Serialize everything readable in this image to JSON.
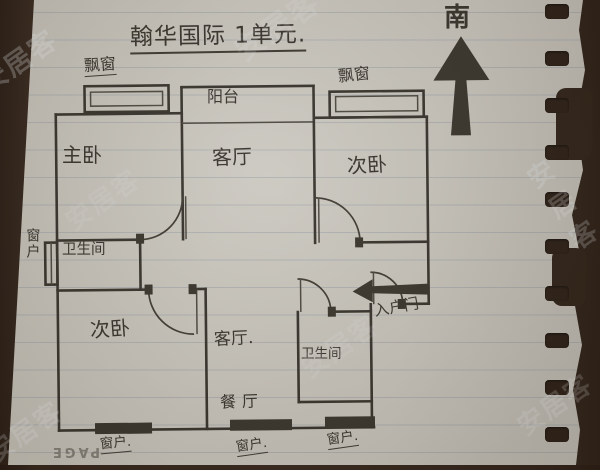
{
  "page": {
    "title": "翰华国际 1单元.",
    "compass": "南",
    "page_print": "PAGE",
    "watermark": "安居客"
  },
  "rooms": {
    "master_bedroom": "主卧",
    "living_room_top": "客厅",
    "second_bedroom_top": "次卧",
    "second_bedroom_bottom": "次卧",
    "living_room_bottom": "客厅.",
    "dining_room": "餐厅",
    "bathroom_top": "卫生间",
    "bathroom_bottom": "卫生间"
  },
  "features": {
    "bay_window_left": "飘窗",
    "bay_window_right": "飘窗",
    "balcony": "阳台",
    "window_left": "窗户",
    "window_bottom_1": "窗户.",
    "window_bottom_2": "窗户.",
    "window_bottom_3": "窗户.",
    "entry_door": "入户门"
  },
  "colors": {
    "paper": "#c9c6be",
    "ink": "#34312a",
    "background": "#33261c",
    "rule_line": "#7d8898",
    "watermark": "#ecf0f5"
  }
}
